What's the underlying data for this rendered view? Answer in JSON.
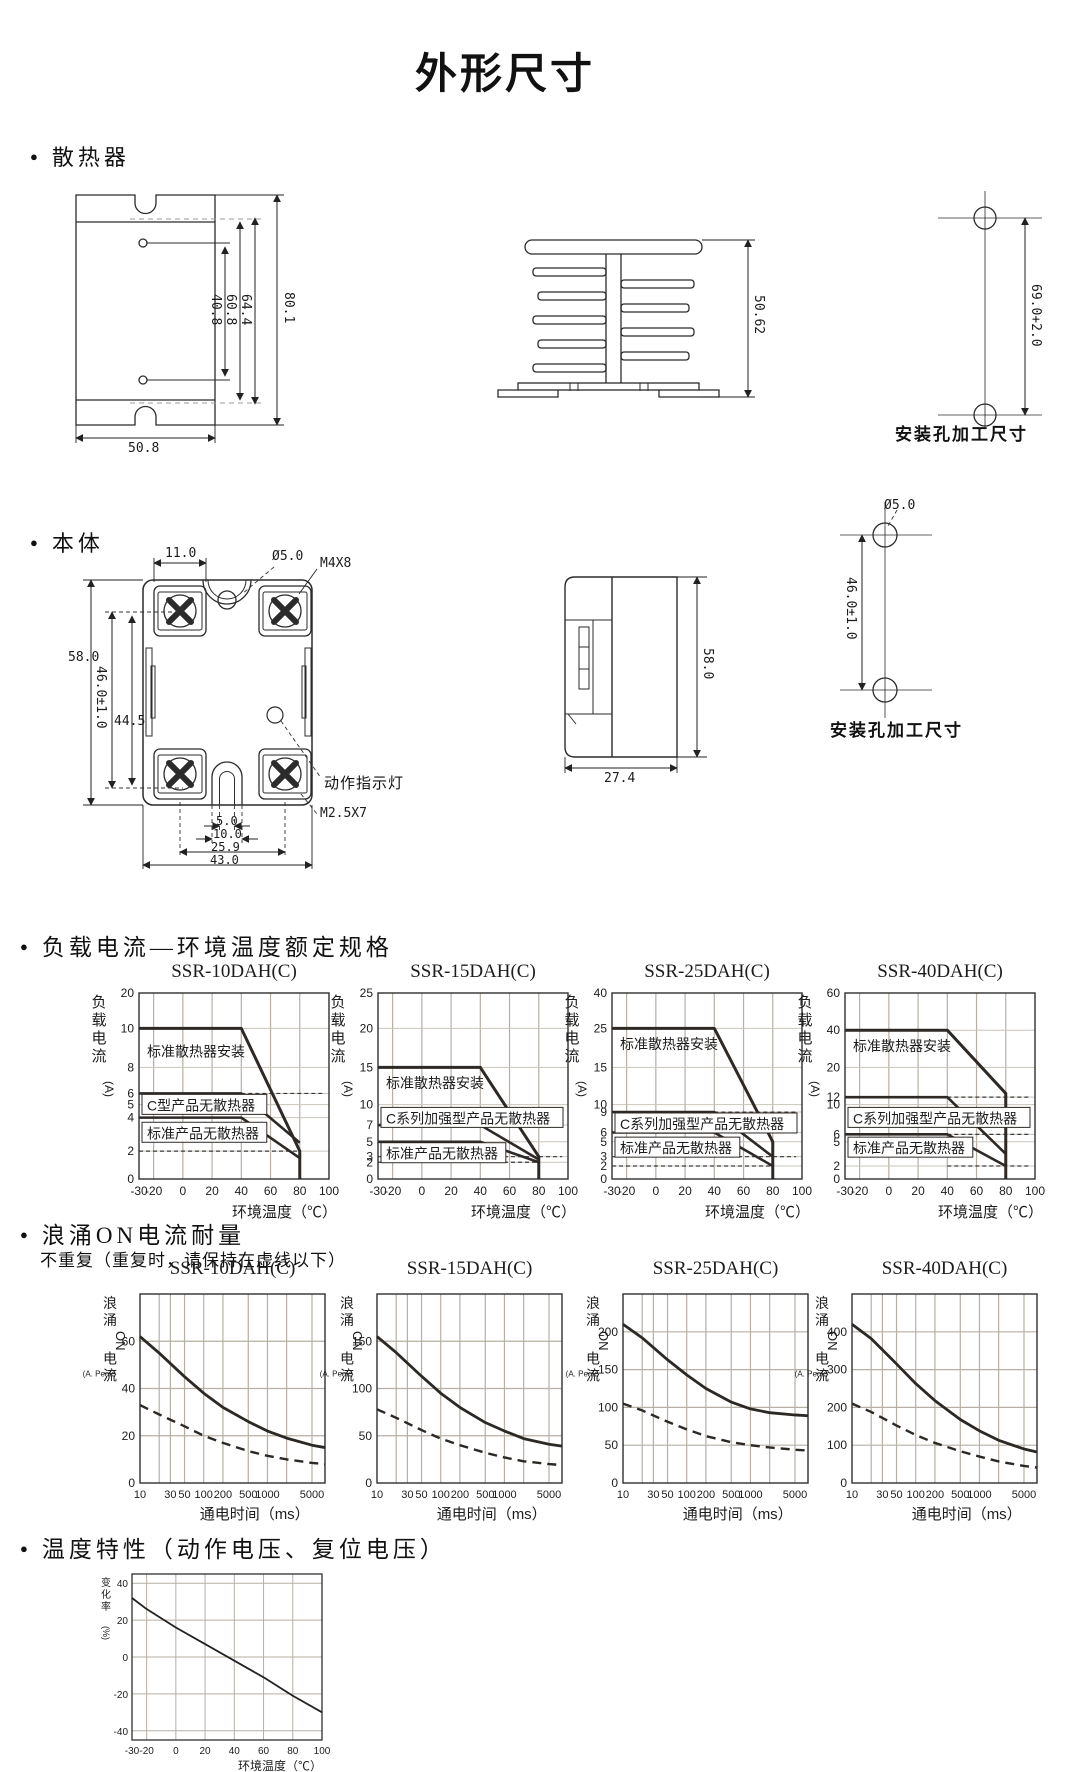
{
  "page": {
    "title": "外形尺寸"
  },
  "ui": {
    "bullet": "●"
  },
  "heatsink": {
    "section_title": "散热器",
    "front": {
      "hole_pitch": "40.8",
      "inner_h": "60.8",
      "mid_h": "64.4",
      "total_h": "80.1",
      "width": "50.8"
    },
    "profile": {
      "height": "50.62"
    },
    "mounting": {
      "pitch": "69.0+2.0",
      "caption": "安装孔加工尺寸"
    }
  },
  "body": {
    "section_title": "本体",
    "front": {
      "top_w": "11.0",
      "hole": "Ø5.0",
      "screw_top": "M4X8",
      "height": "58.0",
      "mount_pitch": "46.0±1.0",
      "inner_h": "44.5",
      "led": "动作指示灯",
      "screw_bottom": "M2.5X7",
      "slot_inner_w": "5.0",
      "slot_w": "10.0",
      "screw_pitch": "25.9",
      "width": "43.0"
    },
    "side": {
      "height": "58.0",
      "depth": "27.4"
    },
    "mounting": {
      "hole": "Ø5.0",
      "pitch": "46.0±1.0",
      "caption": "安装孔加工尺寸"
    }
  },
  "load_section": {
    "title": "负载电流—环境温度额定规格"
  },
  "surge_section": {
    "title": "浪涌ON电流耐量",
    "subtitle": "不重复（重复时，请保持在虚线以下）"
  },
  "temp_section": {
    "title": "温度特性（动作电压、复位电压）"
  },
  "chart_data": [
    {
      "kind": "load",
      "type": "line",
      "title": "SSR-10DAH(C)",
      "xlabel": "环境温度（℃）",
      "ylabel_stack": "负载电流",
      "ylabel_unit": "(A)",
      "xlim": [
        -30,
        100
      ],
      "xticks": [
        -30,
        -20,
        0,
        20,
        40,
        60,
        80,
        100
      ],
      "yticks": [
        20,
        10,
        8,
        6,
        5,
        4,
        2,
        0
      ],
      "ytick_fracs": [
        0,
        0.19,
        0.4,
        0.54,
        0.6,
        0.67,
        0.85,
        1.0
      ],
      "series": [
        {
          "name": "标准散热器安装",
          "boxed": false,
          "label_frac": 0.255,
          "points": [
            [
              -30,
              10
            ],
            [
              40,
              10
            ],
            [
              80,
              2
            ],
            [
              80,
              0
            ]
          ]
        },
        {
          "name": "C型产品无散热器",
          "boxed": true,
          "label_frac": 0.545,
          "points": [
            [
              -30,
              6
            ],
            [
              40,
              6
            ],
            [
              80,
              2.5
            ]
          ]
        },
        {
          "name": "标准产品无散热器",
          "boxed": true,
          "label_frac": 0.695,
          "points": [
            [
              -30,
              4
            ],
            [
              40,
              4
            ],
            [
              80,
              1.5
            ]
          ]
        }
      ],
      "dashed_levels": [
        {
          "level": 6,
          "x": [
            40,
            96
          ]
        },
        {
          "level": 2,
          "x": [
            -30,
            80
          ]
        }
      ]
    },
    {
      "kind": "load",
      "type": "line",
      "title": "SSR-15DAH(C)",
      "xlabel": "环境温度（℃）",
      "ylabel_stack": "负载电流",
      "ylabel_unit": "(A)",
      "xlim": [
        -30,
        100
      ],
      "xticks": [
        -30,
        -20,
        0,
        20,
        40,
        60,
        80,
        100
      ],
      "yticks": [
        25,
        20,
        15,
        10,
        7,
        5,
        3,
        2,
        0
      ],
      "ytick_fracs": [
        0,
        0.19,
        0.4,
        0.6,
        0.71,
        0.8,
        0.88,
        0.91,
        1.0
      ],
      "series": [
        {
          "name": "标准散热器安装",
          "boxed": false,
          "label_frac": 0.425,
          "points": [
            [
              -30,
              15
            ],
            [
              40,
              15
            ],
            [
              80,
              3
            ],
            [
              80,
              0
            ]
          ]
        },
        {
          "name": "C系列加强型产品无散热器",
          "boxed": true,
          "label_frac": 0.615,
          "points": [
            [
              -30,
              7
            ],
            [
              40,
              7
            ],
            [
              80,
              2.5
            ]
          ]
        },
        {
          "name": "标准产品无散热器",
          "boxed": true,
          "label_frac": 0.805,
          "points": [
            [
              -30,
              5
            ],
            [
              40,
              5
            ],
            [
              80,
              2
            ]
          ]
        }
      ],
      "dashed_levels": [
        {
          "level": 7,
          "x": [
            40,
            96
          ]
        },
        {
          "level": 3,
          "x": [
            -30,
            96
          ]
        },
        {
          "level": 2,
          "x": [
            -30,
            80
          ]
        }
      ]
    },
    {
      "kind": "load",
      "type": "line",
      "title": "SSR-25DAH(C)",
      "xlabel": "环境温度（℃）",
      "ylabel_stack": "负载电流",
      "ylabel_unit": "(A)",
      "xlim": [
        -30,
        100
      ],
      "xticks": [
        -30,
        -20,
        0,
        20,
        40,
        60,
        80,
        100
      ],
      "yticks": [
        40,
        25,
        15,
        10,
        9,
        6,
        5,
        3,
        2,
        0
      ],
      "ytick_fracs": [
        0,
        0.19,
        0.4,
        0.6,
        0.64,
        0.75,
        0.8,
        0.88,
        0.93,
        1.0
      ],
      "series": [
        {
          "name": "标准散热器安装",
          "boxed": false,
          "label_frac": 0.215,
          "points": [
            [
              -30,
              25
            ],
            [
              40,
              25
            ],
            [
              80,
              5
            ],
            [
              80,
              0
            ]
          ]
        },
        {
          "name": "C系列加强型产品无散热器",
          "boxed": true,
          "label_frac": 0.645,
          "points": [
            [
              -30,
              9
            ],
            [
              40,
              9
            ],
            [
              80,
              3
            ]
          ]
        },
        {
          "name": "标准产品无散热器",
          "boxed": true,
          "label_frac": 0.775,
          "points": [
            [
              -30,
              6
            ],
            [
              40,
              6
            ],
            [
              80,
              2
            ]
          ]
        }
      ],
      "dashed_levels": [
        {
          "level": 9,
          "x": [
            40,
            96
          ]
        },
        {
          "level": 3,
          "x": [
            -30,
            96
          ]
        },
        {
          "level": 2,
          "x": [
            -30,
            80
          ]
        }
      ]
    },
    {
      "kind": "load",
      "type": "line",
      "title": "SSR-40DAH(C)",
      "xlabel": "环境温度（℃）",
      "ylabel_stack": "负载电流",
      "ylabel_unit": "(A)",
      "xlim": [
        -30,
        100
      ],
      "xticks": [
        -30,
        -20,
        0,
        20,
        40,
        60,
        80,
        100
      ],
      "yticks": [
        60,
        40,
        20,
        12,
        10,
        6,
        5,
        2,
        0
      ],
      "ytick_fracs": [
        0,
        0.2,
        0.4,
        0.56,
        0.6,
        0.76,
        0.8,
        0.93,
        1.0
      ],
      "series": [
        {
          "name": "标准散热器安装",
          "boxed": false,
          "label_frac": 0.225,
          "points": [
            [
              -30,
              40
            ],
            [
              40,
              40
            ],
            [
              80,
              13
            ],
            [
              80,
              0
            ]
          ]
        },
        {
          "name": "C系列加强型产品无散热器",
          "boxed": true,
          "label_frac": 0.615,
          "points": [
            [
              -30,
              12
            ],
            [
              40,
              12
            ],
            [
              80,
              3.5
            ]
          ]
        },
        {
          "name": "标准产品无散热器",
          "boxed": true,
          "label_frac": 0.775,
          "points": [
            [
              -30,
              6
            ],
            [
              40,
              6
            ],
            [
              80,
              2
            ]
          ]
        }
      ],
      "dashed_levels": [
        {
          "level": 12,
          "x": [
            40,
            96
          ]
        },
        {
          "level": 6,
          "x": [
            40,
            96
          ]
        },
        {
          "level": 2,
          "x": [
            40,
            96
          ]
        }
      ]
    },
    {
      "kind": "surge",
      "type": "line",
      "title": "SSR-10DAH(C)",
      "xlabel": "通电时间（ms）",
      "ylabel_stack": "浪涌ON电流",
      "ylabel_unit": "(A. Peak)",
      "xscale": "log",
      "xlim": [
        10,
        8000
      ],
      "xticks": [
        10,
        30,
        50,
        100,
        200,
        500,
        1000,
        5000
      ],
      "ylim": [
        0,
        80
      ],
      "yticks": [
        60,
        40,
        20,
        0
      ],
      "series": [
        {
          "style": "solid",
          "points": [
            [
              10,
              62
            ],
            [
              20,
              55
            ],
            [
              50,
              45
            ],
            [
              100,
              38
            ],
            [
              200,
              32
            ],
            [
              500,
              26
            ],
            [
              1000,
              22
            ],
            [
              2000,
              19
            ],
            [
              5000,
              16
            ],
            [
              8000,
              15
            ]
          ]
        },
        {
          "style": "dashed",
          "points": [
            [
              10,
              33
            ],
            [
              20,
              29
            ],
            [
              50,
              24
            ],
            [
              100,
              20
            ],
            [
              200,
              17
            ],
            [
              500,
              13.5
            ],
            [
              1000,
              11.5
            ],
            [
              2000,
              10
            ],
            [
              5000,
              8.5
            ],
            [
              8000,
              8
            ]
          ]
        }
      ]
    },
    {
      "kind": "surge",
      "type": "line",
      "title": "SSR-15DAH(C)",
      "xlabel": "通电时间（ms）",
      "ylabel_stack": "浪涌ON电流",
      "ylabel_unit": "(A. Peak)",
      "xscale": "log",
      "xlim": [
        10,
        8000
      ],
      "xticks": [
        10,
        30,
        50,
        100,
        200,
        500,
        1000,
        5000
      ],
      "ylim": [
        0,
        200
      ],
      "yticks": [
        150,
        100,
        50,
        0
      ],
      "series": [
        {
          "style": "solid",
          "points": [
            [
              10,
              155
            ],
            [
              20,
              138
            ],
            [
              50,
              113
            ],
            [
              100,
              95
            ],
            [
              200,
              80
            ],
            [
              500,
              64
            ],
            [
              1000,
              55
            ],
            [
              2000,
              47
            ],
            [
              5000,
              41
            ],
            [
              8000,
              39
            ]
          ]
        },
        {
          "style": "dashed",
          "points": [
            [
              10,
              78
            ],
            [
              20,
              69
            ],
            [
              50,
              56
            ],
            [
              100,
              47
            ],
            [
              200,
              40
            ],
            [
              500,
              32
            ],
            [
              1000,
              27
            ],
            [
              2000,
              23
            ],
            [
              5000,
              20
            ],
            [
              8000,
              19
            ]
          ]
        }
      ]
    },
    {
      "kind": "surge",
      "type": "line",
      "title": "SSR-25DAH(C)",
      "xlabel": "通电时间（ms）",
      "ylabel_stack": "浪涌ON电流",
      "ylabel_unit": "(A. Peak)",
      "xscale": "log",
      "xlim": [
        10,
        8000
      ],
      "xticks": [
        10,
        30,
        50,
        100,
        200,
        500,
        1000,
        5000
      ],
      "ylim": [
        0,
        250
      ],
      "yticks": [
        200,
        150,
        100,
        50,
        0
      ],
      "series": [
        {
          "style": "solid",
          "points": [
            [
              10,
              210
            ],
            [
              20,
              192
            ],
            [
              50,
              163
            ],
            [
              100,
              143
            ],
            [
              200,
              125
            ],
            [
              500,
              107
            ],
            [
              1000,
              98
            ],
            [
              2000,
              93
            ],
            [
              5000,
              90
            ],
            [
              8000,
              89
            ]
          ]
        },
        {
          "style": "dashed",
          "points": [
            [
              10,
              105
            ],
            [
              20,
              96
            ],
            [
              50,
              81
            ],
            [
              100,
              71
            ],
            [
              200,
              62
            ],
            [
              500,
              54
            ],
            [
              1000,
              50
            ],
            [
              2000,
              47
            ],
            [
              5000,
              44
            ],
            [
              8000,
              43
            ]
          ]
        }
      ]
    },
    {
      "kind": "surge",
      "type": "line",
      "title": "SSR-40DAH(C)",
      "xlabel": "通电时间（ms）",
      "ylabel_stack": "浪涌ON电流",
      "ylabel_unit": "(A. Peak)",
      "xscale": "log",
      "xlim": [
        10,
        8000
      ],
      "xticks": [
        10,
        30,
        50,
        100,
        200,
        500,
        1000,
        5000
      ],
      "ylim": [
        0,
        500
      ],
      "yticks": [
        400,
        300,
        200,
        100,
        0
      ],
      "series": [
        {
          "style": "solid",
          "points": [
            [
              10,
              420
            ],
            [
              20,
              382
            ],
            [
              50,
              315
            ],
            [
              100,
              263
            ],
            [
              200,
              218
            ],
            [
              500,
              168
            ],
            [
              1000,
              138
            ],
            [
              2000,
              113
            ],
            [
              5000,
              90
            ],
            [
              8000,
              82
            ]
          ]
        },
        {
          "style": "dashed",
          "points": [
            [
              10,
              210
            ],
            [
              20,
              188
            ],
            [
              50,
              152
            ],
            [
              100,
              127
            ],
            [
              200,
              106
            ],
            [
              500,
              84
            ],
            [
              1000,
              70
            ],
            [
              2000,
              57
            ],
            [
              5000,
              45
            ],
            [
              8000,
              41
            ]
          ]
        }
      ]
    },
    {
      "kind": "temp",
      "type": "line",
      "title": "",
      "xlabel": "环境温度（℃）",
      "ylabel_stack": "变化率",
      "ylabel_unit": "(%)",
      "xlim": [
        -30,
        100
      ],
      "xticks": [
        -30,
        -20,
        0,
        20,
        40,
        60,
        80,
        100
      ],
      "ylim": [
        -45,
        45
      ],
      "yticks": [
        40,
        20,
        0,
        -20,
        -40
      ],
      "series": [
        {
          "style": "solid",
          "points": [
            [
              -30,
              32
            ],
            [
              -20,
              26
            ],
            [
              0,
              16
            ],
            [
              20,
              7
            ],
            [
              40,
              -2
            ],
            [
              60,
              -11
            ],
            [
              80,
              -21
            ],
            [
              100,
              -30
            ]
          ]
        }
      ]
    }
  ]
}
